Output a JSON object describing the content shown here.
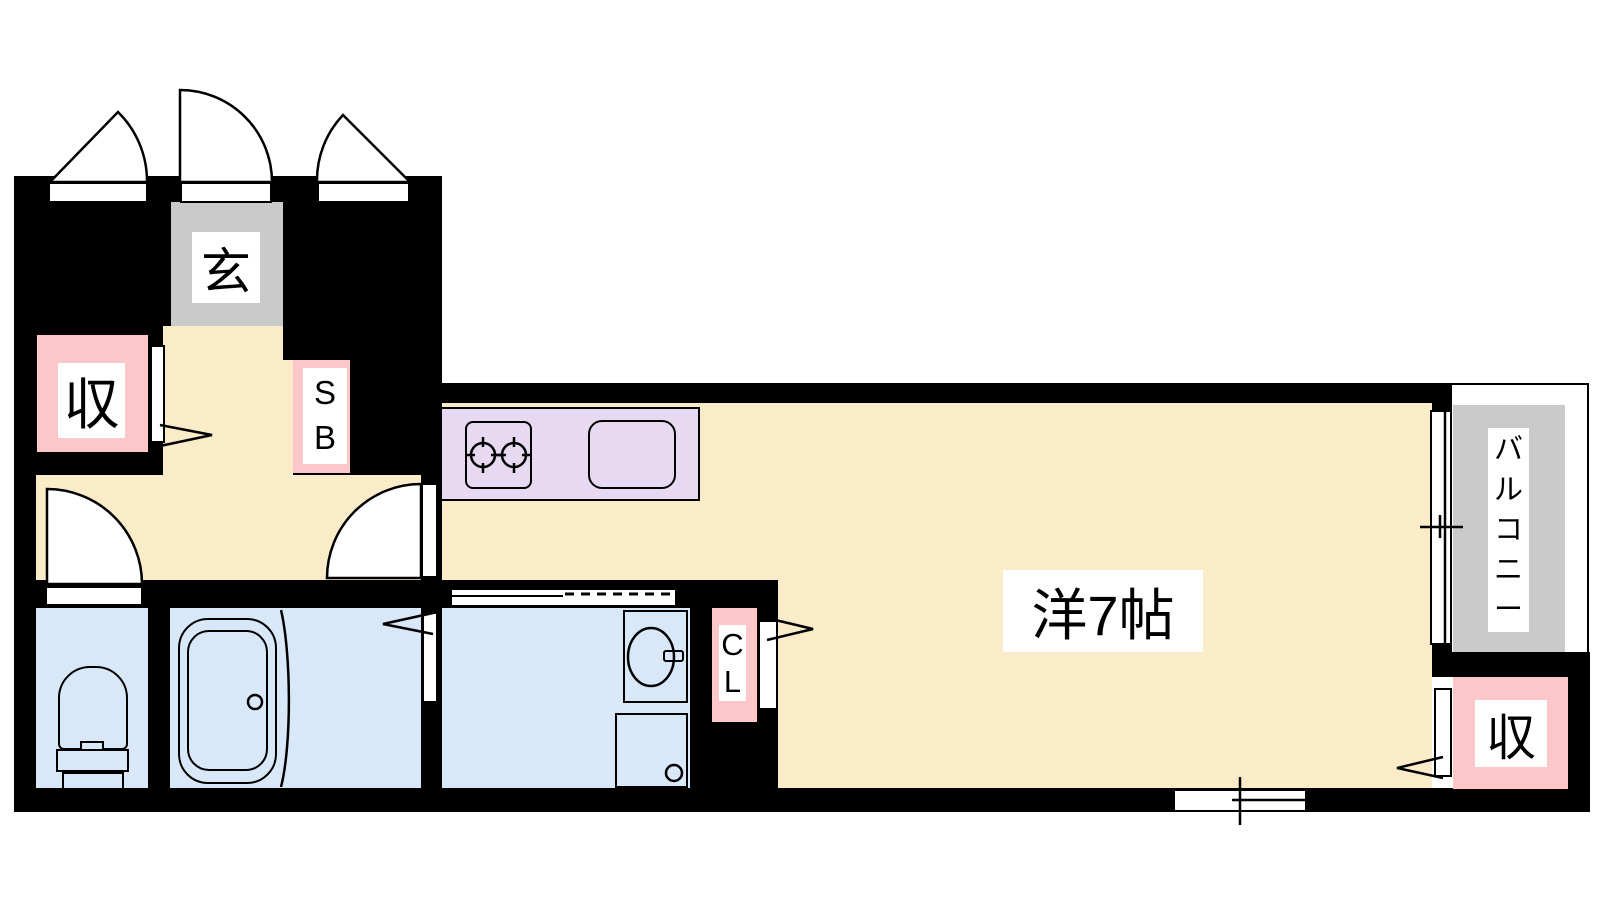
{
  "plan_title": "1R apartment floor plan",
  "rooms": {
    "entrance": {
      "label": "玄"
    },
    "storage_left": {
      "label": "収"
    },
    "shoe_box": {
      "label": "SB"
    },
    "western_room": {
      "label": "洋7帖"
    },
    "closet": {
      "label": "CL"
    },
    "balcony": {
      "label": "バルコニー"
    },
    "storage_right": {
      "label": "収"
    }
  },
  "colors": {
    "wall": "#000000",
    "line": "#000000",
    "floor": "#faecc9",
    "wet_area": "#d9e8f8",
    "storage": "#fbc7c9",
    "kitchen_counter": "#e7d9f1",
    "entrance_gray": "#cacaca",
    "label_bg": "#ffffff"
  }
}
